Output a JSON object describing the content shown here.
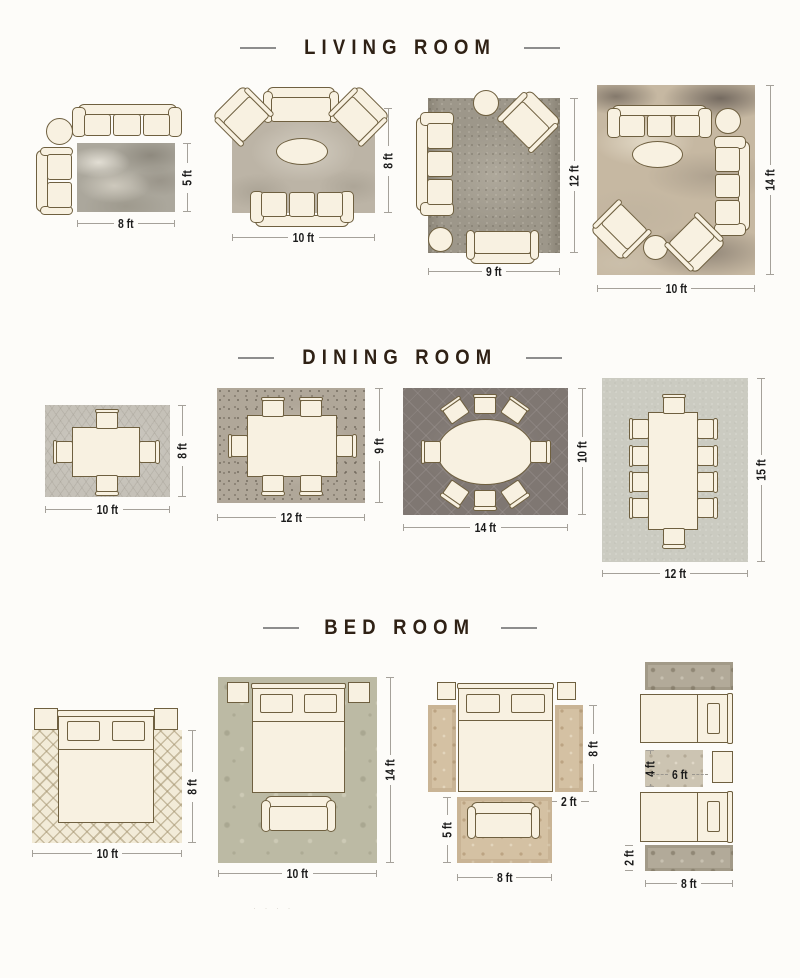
{
  "titles": {
    "living": "LIVING ROOM",
    "dining": "DINING ROOM",
    "bed": "BED ROOM"
  },
  "living": {
    "l1": {
      "w": "8 ft",
      "h": "5 ft"
    },
    "l2": {
      "w": "10 ft",
      "h": "8 ft"
    },
    "l3": {
      "w": "9 ft",
      "h": "12 ft"
    },
    "l4": {
      "w": "10 ft",
      "h": "14 ft"
    }
  },
  "dining": {
    "l1": {
      "w": "10 ft",
      "h": "8 ft"
    },
    "l2": {
      "w": "12 ft",
      "h": "9 ft"
    },
    "l3": {
      "w": "14 ft",
      "h": "10 ft"
    },
    "l4": {
      "w": "12 ft",
      "h": "15 ft"
    }
  },
  "bed": {
    "l1": {
      "w": "10 ft",
      "h": "8 ft"
    },
    "l2": {
      "w": "10 ft",
      "h": "14 ft"
    },
    "l3": {
      "runner_h": "8 ft",
      "runner_w": "2 ft",
      "bench_rug_h": "5 ft",
      "bench_rug_w": "8 ft"
    },
    "l4": {
      "rug_h": "4 ft",
      "rug_w": "6 ft",
      "runner_w": "2 ft",
      "runner_l": "8 ft"
    }
  },
  "watermark": "· · · ·",
  "colors": {
    "background": "#fdfcf9",
    "furniture_fill": "#f8f1e1",
    "furniture_outline": "#6f6040",
    "title_text": "#2f2115",
    "title_dash": "#8d8d8d",
    "dimension_text": "#1c1c1c",
    "dimension_line": "#a5a19a"
  }
}
